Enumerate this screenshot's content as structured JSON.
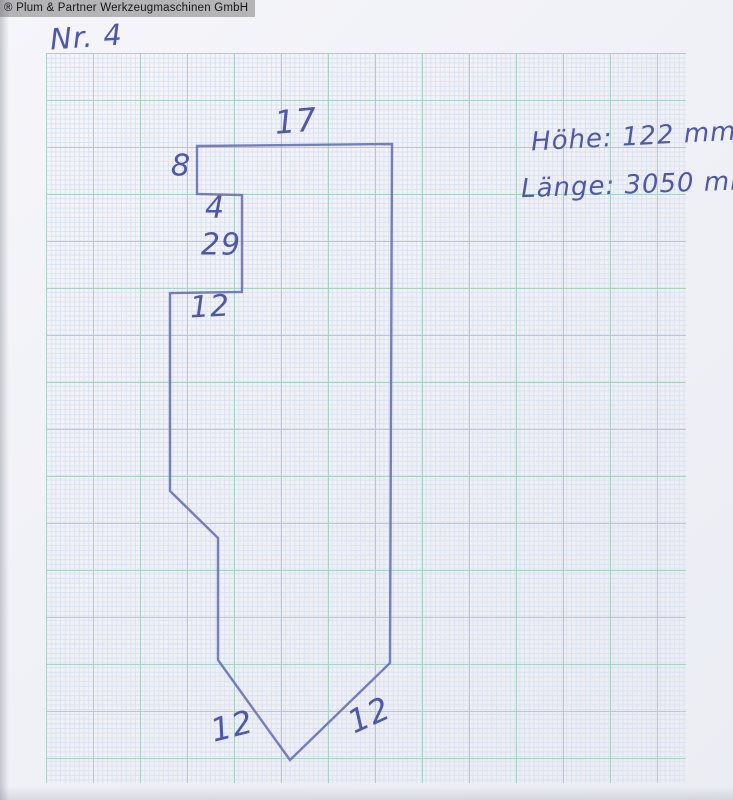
{
  "watermark": {
    "text": "® Plum & Partner Werkzeugmaschinen GmbH"
  },
  "title": {
    "sketch_number": "Nr. 4"
  },
  "notes": {
    "height": "Höhe: 122 mm",
    "length": "Länge: 3050 mm"
  },
  "drawing": {
    "description": "hand-drawn press-brake tool profile outline",
    "ink_color": "#6d73b5",
    "outline_points": [
      [
        197,
        146
      ],
      [
        392,
        144
      ],
      [
        390,
        663
      ],
      [
        290,
        760
      ],
      [
        218,
        660
      ],
      [
        218,
        538
      ],
      [
        170,
        491
      ],
      [
        170,
        293
      ],
      [
        242,
        292
      ],
      [
        242,
        195
      ],
      [
        197,
        194
      ]
    ],
    "dimension_labels": [
      {
        "text": "17",
        "x": 296,
        "y": 121,
        "size": 32,
        "rot": -5
      },
      {
        "text": "8",
        "x": 181,
        "y": 166,
        "size": 30,
        "rot": 2
      },
      {
        "text": "4",
        "x": 215,
        "y": 208,
        "size": 30,
        "rot": 0
      },
      {
        "text": "29",
        "x": 221,
        "y": 245,
        "size": 30,
        "rot": 0
      },
      {
        "text": "12",
        "x": 210,
        "y": 307,
        "size": 30,
        "rot": -3
      },
      {
        "text": "12",
        "x": 232,
        "y": 726,
        "size": 32,
        "rot": -14
      },
      {
        "text": "12",
        "x": 369,
        "y": 715,
        "size": 32,
        "rot": -24
      }
    ]
  },
  "paper": {
    "background": "#f0f1f7",
    "grid_fine_color": "#dbe2ef",
    "grid_major_color": "#a9d2c6",
    "handwriting_color": "#4f58a8"
  }
}
